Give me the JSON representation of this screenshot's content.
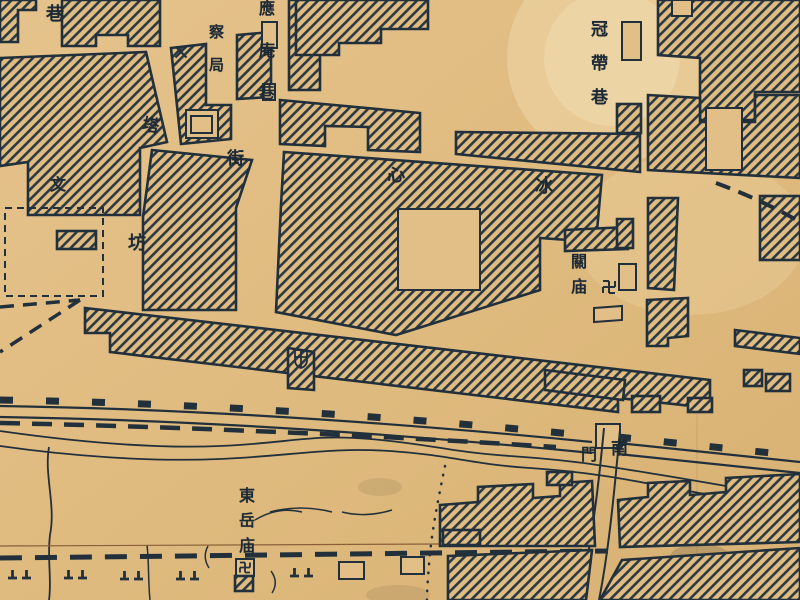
{
  "map": {
    "labels": {
      "lane_partial": "巷",
      "police_bureau": "察局",
      "pagoda": "塔",
      "street": "街",
      "yingan_lane": "應庵巷",
      "wen": "文",
      "fang": "坊",
      "xin": "心",
      "bing": "冰",
      "guandai_lane": "冠帶巷",
      "guan_temple": "關庙",
      "dongyue_temple": "東岳庙",
      "south_gate_right": "南",
      "south_gate_left": "門"
    },
    "icons": [
      "swastika-icon",
      "shield-cross-icon",
      "x-mark-icon",
      "grave-marks-icon",
      "city-wall-crenellation"
    ],
    "colors": {
      "paper": "#e2bf86",
      "paper_stain_light": "#f0d9ac",
      "ink": "#22303c",
      "sepia_line": "#8a5f3a"
    }
  }
}
